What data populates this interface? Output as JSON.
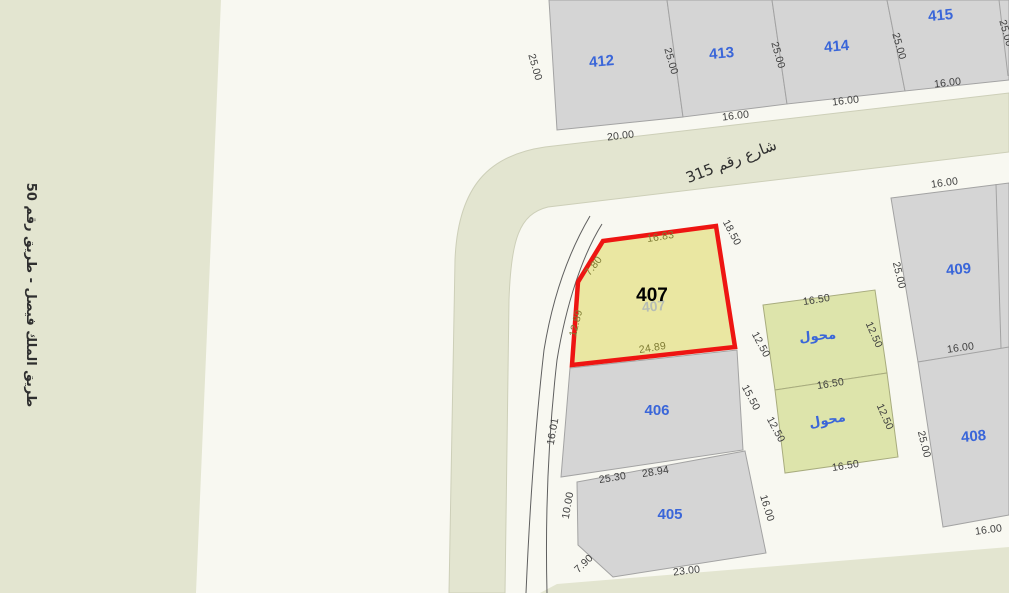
{
  "roads": {
    "left_road_label": "طريق الملك فيصل - طريق رقم 50",
    "street_315_label": "شارع رقم 315"
  },
  "highlight": {
    "parcel_number": "407",
    "shadow_number": "407",
    "fill_color": "#eae7a2",
    "outline_color": "#ee1512",
    "dims": [
      {
        "text": "16.83",
        "x": 661,
        "y": 240,
        "r": -9
      },
      {
        "text": "7.80",
        "x": 596,
        "y": 268,
        "r": -52
      },
      {
        "text": "12.89",
        "x": 579,
        "y": 324,
        "r": -76
      },
      {
        "text": "24.89",
        "x": 653,
        "y": 351,
        "r": -9
      }
    ]
  },
  "parcel_labels": [
    {
      "text": "405",
      "x": 670,
      "y": 519,
      "r": 0
    },
    {
      "text": "406",
      "x": 657,
      "y": 415,
      "r": 0
    },
    {
      "text": "408",
      "x": 974,
      "y": 441,
      "r": -5
    },
    {
      "text": "409",
      "x": 959,
      "y": 274,
      "r": -5
    },
    {
      "text": "412",
      "x": 602,
      "y": 66,
      "r": -5
    },
    {
      "text": "413",
      "x": 722,
      "y": 58,
      "r": -5
    },
    {
      "text": "414",
      "x": 837,
      "y": 51,
      "r": -5
    },
    {
      "text": "415",
      "x": 941,
      "y": 20,
      "r": -5
    }
  ],
  "transformer_labels": [
    {
      "text": "محول",
      "x": 818,
      "y": 340,
      "r": -5
    },
    {
      "text": "محول",
      "x": 828,
      "y": 424,
      "r": -10
    }
  ],
  "dim_labels": [
    {
      "text": "25.00",
      "x": 532,
      "y": 68,
      "r": 74
    },
    {
      "text": "25.00",
      "x": 668,
      "y": 62,
      "r": 74
    },
    {
      "text": "25.00",
      "x": 775,
      "y": 56,
      "r": 74
    },
    {
      "text": "25.00",
      "x": 896,
      "y": 47,
      "r": 74
    },
    {
      "text": "25.00",
      "x": 1003,
      "y": 34,
      "r": 74
    },
    {
      "text": "20.00",
      "x": 621,
      "y": 139,
      "r": -7
    },
    {
      "text": "16.00",
      "x": 736,
      "y": 119,
      "r": -7
    },
    {
      "text": "16.00",
      "x": 846,
      "y": 104,
      "r": -7
    },
    {
      "text": "16.00",
      "x": 948,
      "y": 86,
      "r": -7
    },
    {
      "text": "16.00",
      "x": 945,
      "y": 186,
      "r": -8
    },
    {
      "text": "25.00",
      "x": 896,
      "y": 276,
      "r": 76
    },
    {
      "text": "16.00",
      "x": 961,
      "y": 351,
      "r": -8
    },
    {
      "text": "25.00",
      "x": 921,
      "y": 445,
      "r": 76
    },
    {
      "text": "16.00",
      "x": 989,
      "y": 533,
      "r": -8
    },
    {
      "text": "18.50",
      "x": 729,
      "y": 234,
      "r": 62
    },
    {
      "text": "12.50",
      "x": 758,
      "y": 346,
      "r": 62
    },
    {
      "text": "16.50",
      "x": 817,
      "y": 303,
      "r": -9
    },
    {
      "text": "12.50",
      "x": 871,
      "y": 336,
      "r": 66
    },
    {
      "text": "15.50",
      "x": 748,
      "y": 399,
      "r": 62
    },
    {
      "text": "16.50",
      "x": 831,
      "y": 387,
      "r": -9
    },
    {
      "text": "12.50",
      "x": 773,
      "y": 431,
      "r": 62
    },
    {
      "text": "12.50",
      "x": 882,
      "y": 418,
      "r": 66
    },
    {
      "text": "16.50",
      "x": 846,
      "y": 469,
      "r": -9
    },
    {
      "text": "16.01",
      "x": 556,
      "y": 432,
      "r": -80
    },
    {
      "text": "25.30",
      "x": 613,
      "y": 481,
      "r": -9
    },
    {
      "text": "28.94",
      "x": 656,
      "y": 475,
      "r": -9
    },
    {
      "text": "10.00",
      "x": 571,
      "y": 506,
      "r": -80
    },
    {
      "text": "7.90",
      "x": 586,
      "y": 566,
      "r": -44
    },
    {
      "text": "23.00",
      "x": 687,
      "y": 574,
      "r": -7
    },
    {
      "text": "16.00",
      "x": 764,
      "y": 509,
      "r": 73
    }
  ],
  "colors": {
    "background": "#f8f8f1",
    "road_fill": "#e3e5d0",
    "parcel_fill": "#d5d5d5",
    "transformer_fill": "#dde4ab",
    "highlight_fill": "#eae7a2",
    "highlight_outline": "#ee1512",
    "parcel_number_blue": "#3a66d9",
    "dimension_text": "#3e3e3e"
  }
}
